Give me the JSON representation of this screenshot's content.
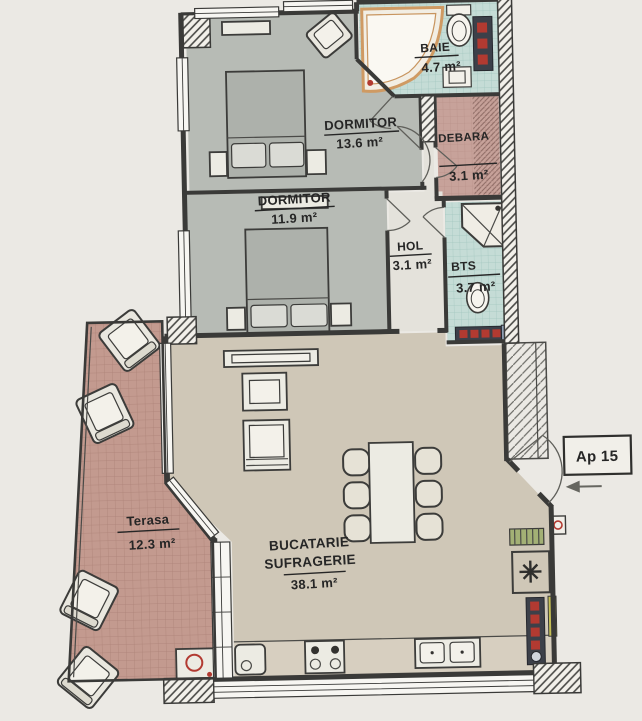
{
  "plan": {
    "rooms": {
      "baie": {
        "name": "BAIE",
        "area": "4.7 m²"
      },
      "dormitor_mare": {
        "name": "DORMITOR",
        "area": "13.6 m²"
      },
      "debara": {
        "name": "DEBARA",
        "area": "3.1 m²"
      },
      "dormitor_mic": {
        "name": "DORMITOR",
        "area": "11.9 m²"
      },
      "hol": {
        "name": "HOL",
        "area": "3.1 m²"
      },
      "bts": {
        "name": "BTS",
        "area": "3.7 m²"
      },
      "terasa": {
        "name": "Terasa",
        "area": "12.3 m²"
      },
      "bucatarie": {
        "name_line1": "BUCATARIE",
        "name_line2": "SUFRAGERIE",
        "area": "38.1 m²"
      }
    },
    "apartment_badge": {
      "label": "Ap 15"
    },
    "colors": {
      "paper": "#ebe9e4",
      "wall": "#3a3a38",
      "text": "#262626",
      "bedroom_floor": "#b7bbb5",
      "living_floor": "#cfc7b7",
      "counter": "#d7cfc0",
      "hol_floor": "#e4e2db",
      "bath_tile": "#c5dcd6",
      "bath_tile_line": "#a2c6be",
      "debara_floor": "#c7a29a",
      "terasa_floor": "#c39a8f",
      "terasa_tile_line": "#ab8176",
      "tub_rim": "#cf9a63",
      "radiator_dark": "#3c4049",
      "accent_red": "#b23a31",
      "accent_yellow": "#c5bf55",
      "accent_green": "#a3b075"
    }
  }
}
